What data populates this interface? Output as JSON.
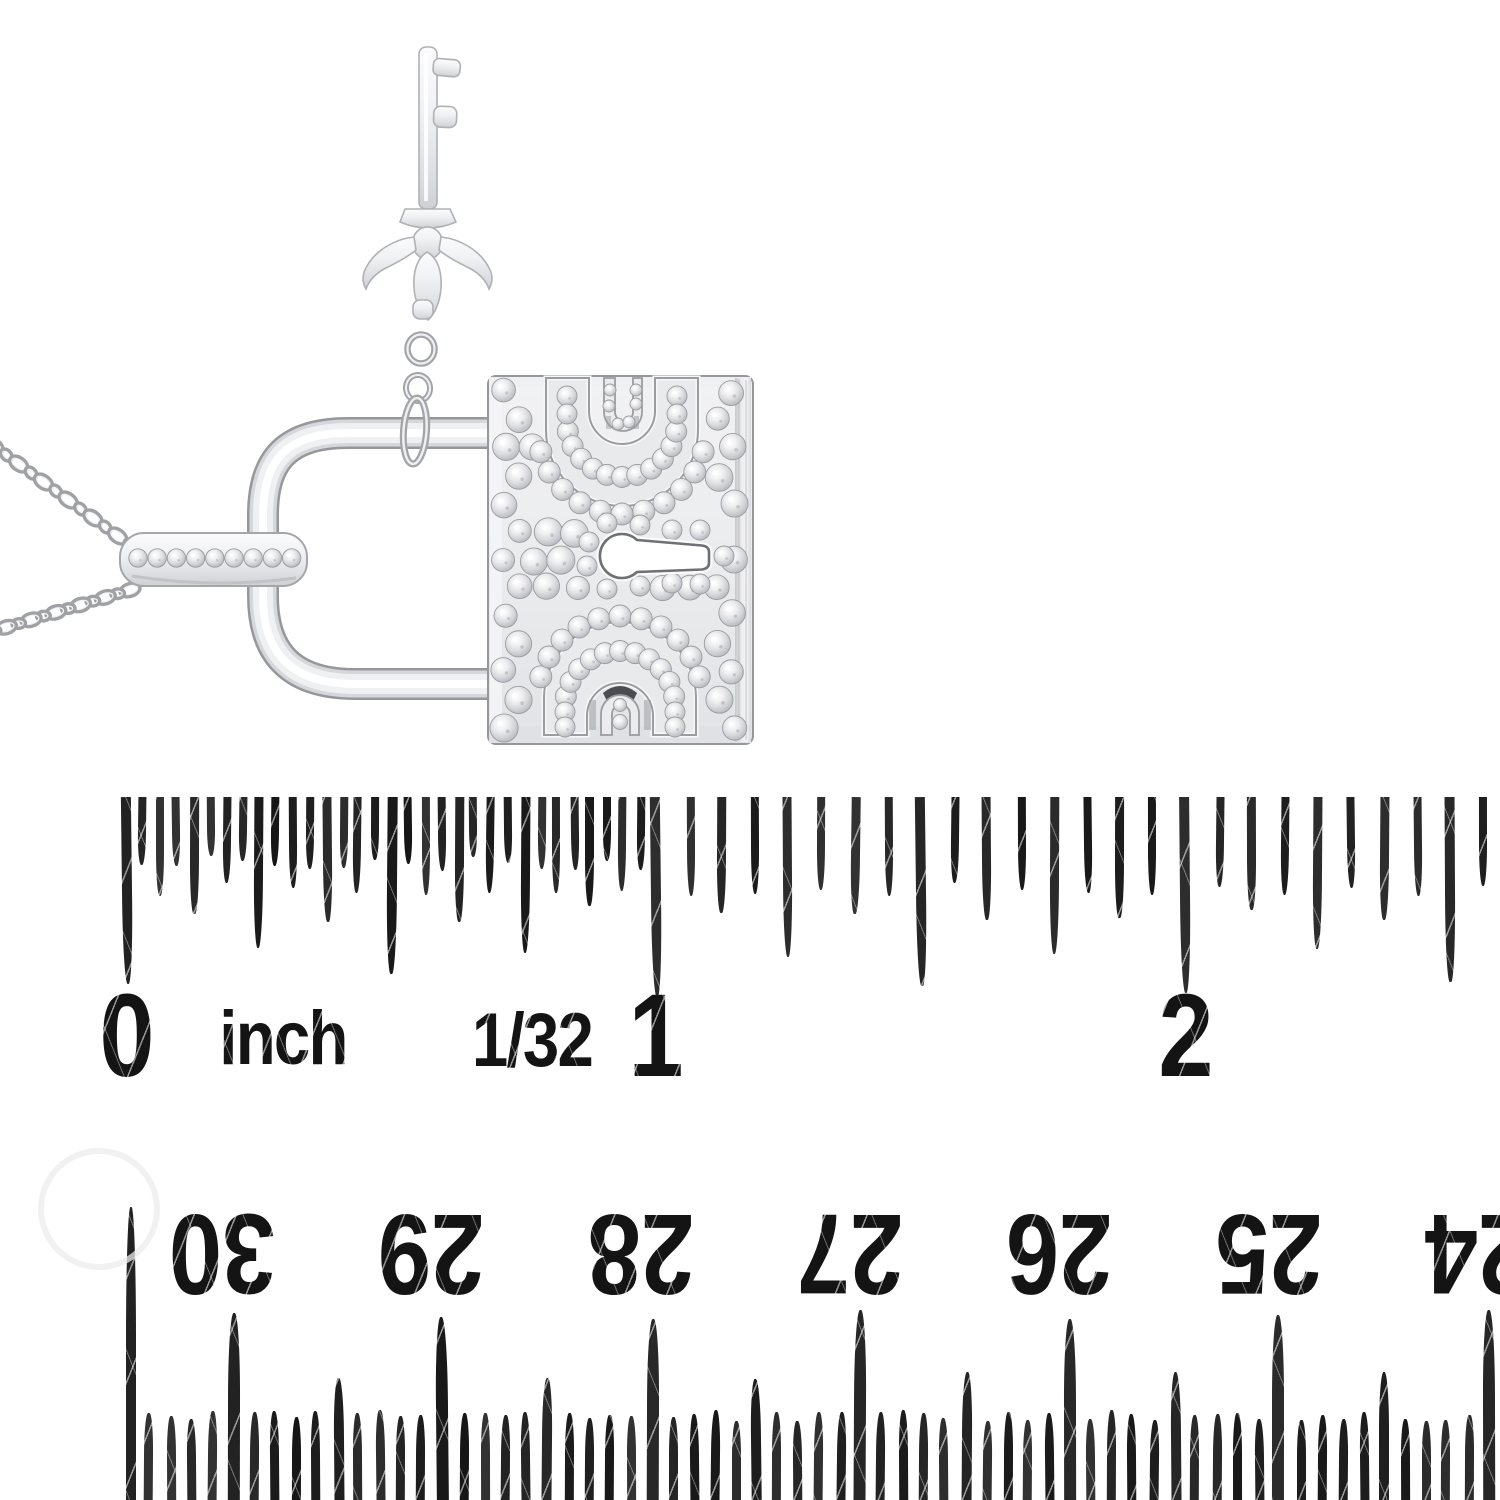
{
  "scene": {
    "background": "#ffffff",
    "description": "White-gold diamond padlock pendant with key charm on a cable-chain necklace, photographed above an inch ruler and an upside-down centimetre ruler"
  },
  "pendant": {
    "parts": {
      "necklace_chain": "cable-link chain",
      "bail": "diamond-set bail",
      "shackle": "polished U-shackle",
      "lock_body": "pave diamond lock face with keyhole",
      "key": "key charm with fleur-de-lis bow"
    },
    "colors": {
      "metal_light": "#fbfbfc",
      "metal_mid": "#e8e9eb",
      "metal_shadow": "#a0a1a5",
      "metal_outline": "#b0b1b5",
      "diamond_edge": "#9b9ca0",
      "keyhole_outline": "#6f7074",
      "dark_accent": "#4b4c4f"
    }
  },
  "top_ruler": {
    "unit_label": "inch",
    "scale_label": "1/32",
    "ink": "#161616",
    "inch_marks": [
      {
        "value": 0,
        "label": "0"
      },
      {
        "value": 1,
        "label": "1"
      },
      {
        "value": 2,
        "label": "2"
      }
    ]
  },
  "bottom_ruler": {
    "unit": "cm",
    "orientation": "upside-down",
    "ink": "#161616",
    "cm_marks": [
      {
        "value": 30,
        "label": "30"
      },
      {
        "value": 29,
        "label": "29"
      },
      {
        "value": 28,
        "label": "28"
      },
      {
        "value": 27,
        "label": "27"
      },
      {
        "value": 26,
        "label": "26"
      },
      {
        "value": 25,
        "label": "25"
      },
      {
        "value": 24,
        "label": "24"
      }
    ]
  }
}
